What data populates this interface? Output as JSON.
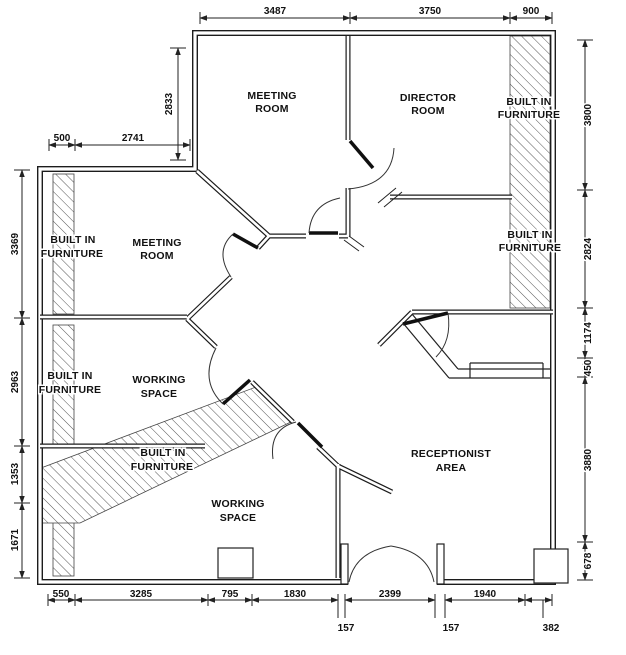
{
  "labels": {
    "meeting_room_top": {
      "l1": "MEETING",
      "l2": "ROOM"
    },
    "director_room": {
      "l1": "DIRECTOR",
      "l2": "ROOM"
    },
    "built_in_top_right": {
      "l1": "BUILT IN",
      "l2": "FURNITURE"
    },
    "built_in_left_upper": {
      "l1": "BUILT IN",
      "l2": "FURNITURE"
    },
    "meeting_room_left": {
      "l1": "MEETING",
      "l2": "ROOM"
    },
    "built_in_right_mid": {
      "l1": "BUILT IN",
      "l2": "FURNITURE"
    },
    "built_in_left_lower": {
      "l1": "BUILT IN",
      "l2": "FURNITURE"
    },
    "working_space_left": {
      "l1": "WORKING",
      "l2": "SPACE"
    },
    "built_in_band": {
      "l1": "BUILT IN",
      "l2": "FURNITURE"
    },
    "working_space_bottom": {
      "l1": "WORKING",
      "l2": "SPACE"
    },
    "receptionist_area": {
      "l1": "RECEPTIONIST",
      "l2": "AREA"
    }
  },
  "dims": {
    "top": [
      "3487",
      "3750",
      "900"
    ],
    "upper_left": [
      "500",
      "2741"
    ],
    "left_inner": "2833",
    "left": [
      "3369",
      "2963",
      "1353",
      "1671"
    ],
    "right": [
      "3800",
      "2824",
      "1174",
      "450",
      "3880",
      "678"
    ],
    "bottom": [
      "550",
      "3285",
      "795",
      "1830",
      "2399",
      "1940"
    ],
    "bottom_offsets": [
      "157",
      "157",
      "382"
    ]
  }
}
